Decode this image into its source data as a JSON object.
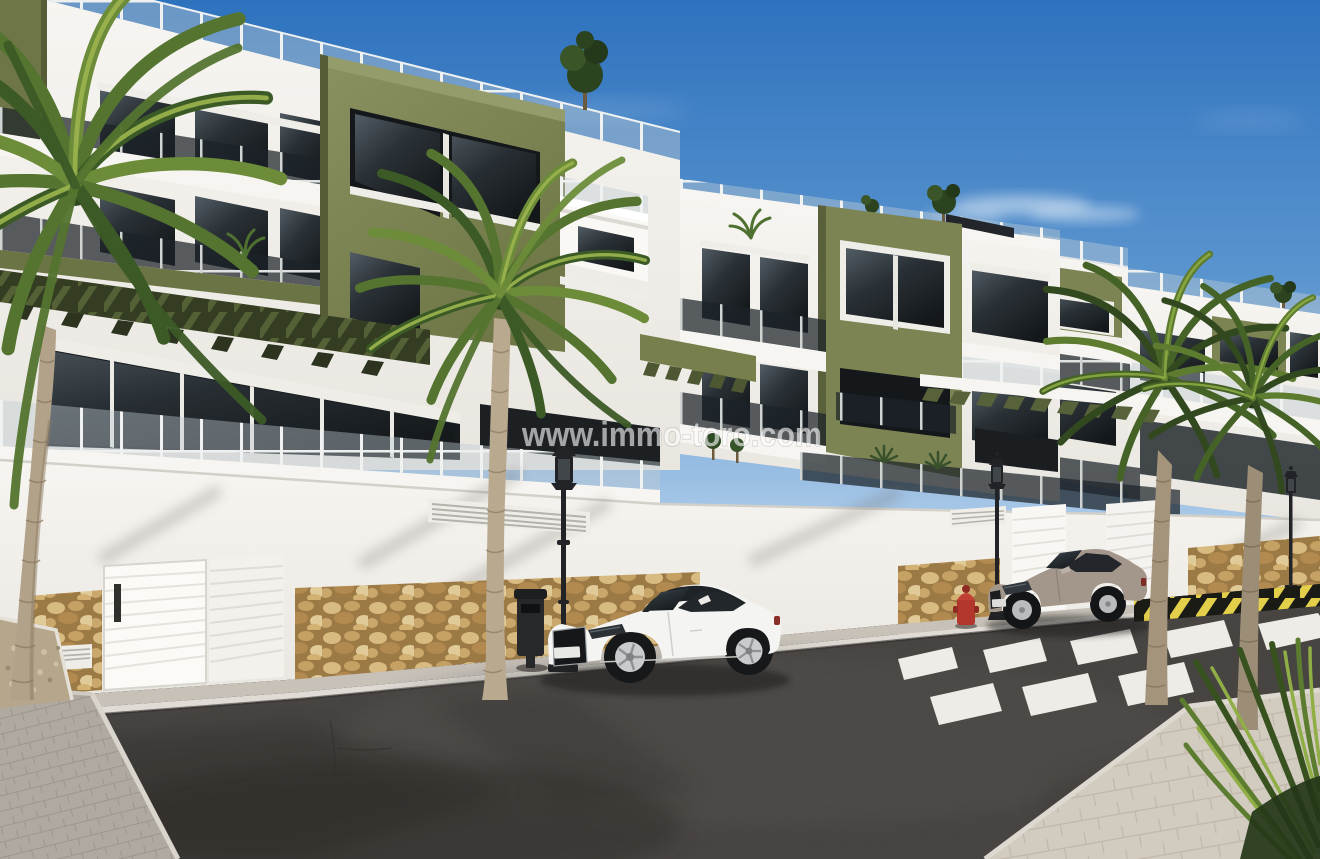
{
  "scene": {
    "title": "New-build apartment complex street view (3D real-estate render)",
    "watermark": {
      "text": "www.immo-toro.com"
    },
    "objects": [
      "apartment-buildings",
      "rooftop-terraces",
      "glass-balustrades",
      "olive-accent-volumes",
      "green-pergola-slats",
      "perimeter-wall",
      "garage-doors",
      "stone-cladding",
      "palm-trees",
      "rooftop-trees",
      "street-lamps",
      "litter-bin",
      "fire-hydrant",
      "white-coupe-car",
      "beige-coupe-car",
      "zebra-crosswalk",
      "asphalt-road",
      "sidewalks",
      "hazard-striped-curb",
      "planting-bed",
      "watermark"
    ],
    "colors": {
      "sky_top": "#2e72be",
      "sky_horizon": "#cfe2f2",
      "facade_white": "#f5f3ef",
      "facade_shadow": "#e4e1db",
      "accent_olive": "#7c8454",
      "accent_olive_dark": "#59613a",
      "pergola_green": "#4d5731",
      "glass_dark": "#22272b",
      "railing_glass": "#aebbc2",
      "stone_tan": "#c9a768",
      "stone_grout": "#9c7a45",
      "asphalt": "#474442",
      "sidewalk_left": "#b0a9a0",
      "sidewalk_right": "#d2cbbf",
      "crosswalk_white": "#edece6",
      "curb": "#e0dcd5",
      "car_white": "#f4f4f2",
      "car_beige": "#a3978c",
      "lamp_black": "#212326",
      "bin_black": "#26282a",
      "hydrant_red": "#b3362c",
      "hazard_yellow": "#e3cf4a",
      "hazard_black": "#1b1b15",
      "palm_green": "#54742f",
      "palm_light": "#9cb54e",
      "palm_dark": "#3a5524",
      "trunk_tan": "#b3a28a"
    }
  }
}
